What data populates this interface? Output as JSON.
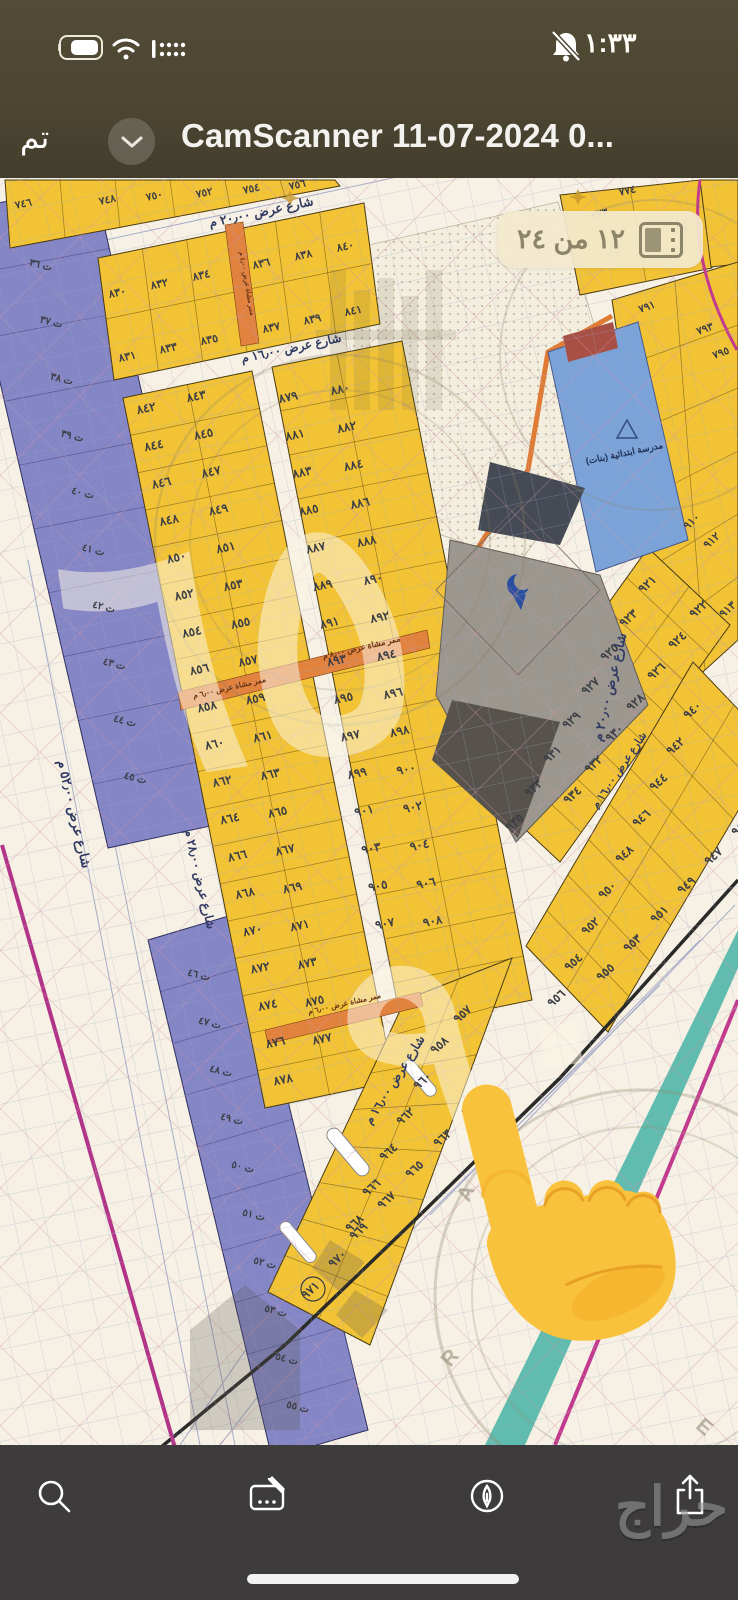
{
  "status_bar": {
    "time": "١:٣٣",
    "icons": [
      "battery-icon",
      "wifi-icon",
      "cellular-dots-icon",
      "bell-slash-icon"
    ]
  },
  "nav_bar": {
    "done_label": "تم",
    "collapse_icon": "chevron-down",
    "title": "CamScanner 11-07-2024 0..."
  },
  "page_badge": {
    "label": "١٢ من ٢٤",
    "icon": "pages-icon"
  },
  "toolbar": {
    "items": [
      {
        "name": "search",
        "icon": "magnifier-icon"
      },
      {
        "name": "markup",
        "icon": "markup-icon"
      },
      {
        "name": "annotate",
        "icon": "pen-circle-icon"
      },
      {
        "name": "share",
        "icon": "share-icon"
      }
    ]
  },
  "overlay": {
    "brand_watermark": "حراج",
    "pointer_emoji": "backhand-index-pointing-up"
  },
  "colors": {
    "plot_yellow": "#f2c335",
    "commercial_purple": "#8486c6",
    "school_blue": "#7ba3d8",
    "walkway_orange": "#e2823f",
    "boundary_teal": "#5fbcae",
    "boundary_magenta": "#b23488",
    "nav_bg": "#4a4432",
    "toolbar_bg": "#3d3b3c",
    "badge_bg": "#f2e9cd",
    "badge_text": "#8d8569"
  },
  "map": {
    "street_labels": [
      {
        "text": "شارع عرض ٢٠٫٠٠ م",
        "x": 262,
        "y": 216,
        "rot": -12,
        "size": 12.5
      },
      {
        "text": "شارع عرض ١٦٫٠٠ م",
        "x": 292,
        "y": 352,
        "rot": -12,
        "size": 12
      },
      {
        "text": "شارع عرض ٢٨٫٠٠ م",
        "x": 196,
        "y": 880,
        "rot": 77,
        "size": 12
      },
      {
        "text": "شارع عرض ٥٢٫٠٠ م",
        "x": 70,
        "y": 815,
        "rot": 77,
        "size": 13
      },
      {
        "text": "شارع عرض ٢٠٫٠٠ م",
        "x": 614,
        "y": 688,
        "rot": -77,
        "size": 13
      },
      {
        "text": "شارع عرض ١٦٫٠٠ م",
        "x": 622,
        "y": 772,
        "rot": -56,
        "size": 10.5
      },
      {
        "text": "شارع عرض ١٦٫٠٠ م",
        "x": 398,
        "y": 1082,
        "rot": -58,
        "size": 12
      }
    ],
    "walkway_labels": [
      {
        "text": "ممر مشاة عرض ٨٫٠٠ م",
        "x": 362,
        "y": 650,
        "rot": -13,
        "size": 8
      },
      {
        "text": "ممر مشاة عرض ٦٫٠٠ م",
        "x": 230,
        "y": 690,
        "rot": -13,
        "size": 7.5
      },
      {
        "text": "ممر مشاة عرض ٦٫٠٠ م",
        "x": 345,
        "y": 1006,
        "rot": -13,
        "size": 7.5
      },
      {
        "text": "ممر مشاة عرض ٤٫٠٠ م",
        "x": 245,
        "y": 284,
        "rot": 80,
        "size": 6.5
      }
    ],
    "poi_labels": [
      {
        "text": "مدرسة ابتدائية (بنات)",
        "x": 625,
        "y": 456,
        "rot": -12,
        "size": 9
      }
    ],
    "plot_series": [
      {
        "labels": [
          "٨٣٠",
          "٨٣٢",
          "٨٣٤"
        ],
        "x": 118,
        "y": 296,
        "dx": 42,
        "dy": -8.6,
        "rot": -12,
        "size": 11
      },
      {
        "labels": [
          "٨٣٦",
          "٨٣٨",
          "٨٤٠"
        ],
        "x": 262,
        "y": 267,
        "dx": 42,
        "dy": -8.6,
        "rot": -12,
        "size": 11
      },
      {
        "labels": [
          "٨٣١",
          "٨٣٣",
          "٨٣٥"
        ],
        "x": 128,
        "y": 360,
        "dx": 41,
        "dy": -8.4,
        "rot": -12,
        "size": 11
      },
      {
        "labels": [
          "٨٣٧",
          "٨٣٩",
          "٨٤١"
        ],
        "x": 272,
        "y": 331,
        "dx": 41,
        "dy": -8.4,
        "rot": -12,
        "size": 11
      },
      {
        "labels": [
          "٨٤٢",
          "٨٤٤",
          "٨٤٦",
          "٨٤٨",
          "٨٥٠",
          "٨٥٢",
          "٨٥٤",
          "٨٥٦",
          "٨٥٨",
          "٨٦٠",
          "٨٦٢",
          "٨٦٤",
          "٨٦٦",
          "٨٦٨",
          "٨٧٠",
          "٨٧٢",
          "٨٧٤",
          "٨٧٦",
          "٨٧٨"
        ],
        "x": 147,
        "y": 412,
        "dx": 7.6,
        "dy": 37.3,
        "rot": -12,
        "size": 12
      },
      {
        "labels": [
          "٨٤٣",
          "٨٤٥",
          "٨٤٧",
          "٨٤٩",
          "٨٥١",
          "٨٥٣",
          "٨٥٥",
          "٨٥٧",
          "٨٥٩",
          "٨٦١",
          "٨٦٣",
          "٨٦٥",
          "٨٦٧",
          "٨٦٩",
          "٨٧١",
          "٨٧٣",
          "٨٧٥",
          "٨٧٧"
        ],
        "x": 197,
        "y": 400,
        "dx": 7.4,
        "dy": 37.8,
        "rot": -12,
        "size": 12
      },
      {
        "labels": [
          "٨٧٩",
          "٨٨١",
          "٨٨٣",
          "٨٨٥",
          "٨٨٧",
          "٨٨٩",
          "٨٩١",
          "٨٩٣",
          "٨٩٥",
          "٨٩٧",
          "٨٩٩",
          "٩٠١",
          "٩٠٣",
          "٩٠٥",
          "٩٠٧"
        ],
        "x": 289,
        "y": 401,
        "dx": 6.9,
        "dy": 37.6,
        "rot": -12,
        "size": 12
      },
      {
        "labels": [
          "٨٨٠",
          "٨٨٢",
          "٨٨٤",
          "٨٨٦",
          "٨٨٨",
          "٨٩٠",
          "٨٩٢",
          "٨٩٤",
          "٨٩٦",
          "٨٩٨",
          "٩٠٠",
          "٩٠٢",
          "٩٠٤",
          "٩٠٦",
          "٩٠٨"
        ],
        "x": 341,
        "y": 393,
        "dx": 6.6,
        "dy": 38,
        "rot": -12,
        "size": 12
      },
      {
        "labels": [
          "٩٢١",
          "٩٢٣",
          "٩٢٥",
          "٩٢٧",
          "٩٢٩",
          "٩٣١",
          "٩٣٣",
          "٩٣٥"
        ],
        "x": 650,
        "y": 587,
        "dx": -19,
        "dy": 34,
        "rot": -42,
        "size": 12
      },
      {
        "labels": [
          "٩٢٢",
          "٩٢٤",
          "٩٢٦",
          "٩٢٨",
          "٩٣٠",
          "٩٣٢",
          "٩٣٤"
        ],
        "x": 701,
        "y": 612,
        "dx": -21,
        "dy": 31,
        "rot": -42,
        "size": 12
      },
      {
        "labels": [
          "٩٤٠",
          "٩٤٢",
          "٩٤٤",
          "٩٤٦",
          "٩٤٨",
          "٩٥٠",
          "٩٥٢",
          "٩٥٤",
          "٩٥٦"
        ],
        "x": 695,
        "y": 713,
        "dx": -17,
        "dy": 36,
        "rot": -42,
        "size": 12
      },
      {
        "labels": [
          "٩٤٥",
          "٩٤٧",
          "٩٤٩",
          "٩٥١",
          "٩٥٣",
          "٩٥٥"
        ],
        "x": 743,
        "y": 830,
        "dx": -27,
        "dy": 29,
        "rot": -42,
        "size": 12
      },
      {
        "labels": [
          "٩٥٨",
          "٩٦٠",
          "٩٦٢",
          "٩٦٤",
          "٩٦٦",
          "٩٦٨",
          "٩٧٠"
        ],
        "x": 442,
        "y": 1048,
        "dx": -17,
        "dy": 35.6,
        "rot": -42,
        "size": 12
      },
      {
        "labels": [
          "٩٦١",
          "٩٦٣",
          "٩٦٥",
          "٩٦٧",
          "٩٦٩"
        ],
        "x": 473,
        "y": 1110,
        "dx": -28,
        "dy": 31,
        "rot": -42,
        "size": 12
      },
      {
        "labels": [
          "ت ٣٦",
          "ت ٣٧",
          "ت ٣٨",
          "ت ٣٩",
          "ت ٤٠",
          "ت ٤١",
          "ت ٤٢",
          "ت ٤٣",
          "ت ٤٤",
          "ت ٤٥"
        ],
        "x": 40,
        "y": 268,
        "dx": 10.5,
        "dy": 57,
        "rot": 14,
        "size": 10
      },
      {
        "labels": [
          "ت ٤٦",
          "ت ٤٧",
          "ت ٤٨",
          "ت ٤٩",
          "ت ٥٠",
          "ت ٥١",
          "ت ٥٢",
          "ت ٥٣",
          "ت ٥٤",
          "ت ٥٥"
        ],
        "x": 198,
        "y": 978,
        "dx": 11,
        "dy": 48,
        "rot": 14,
        "size": 10
      }
    ],
    "plot_singles": [
      {
        "n": "٧٤٦",
        "x": 24,
        "y": 207,
        "rot": -12,
        "size": 10.5
      },
      {
        "n": "٧٤٨",
        "x": 108,
        "y": 203,
        "rot": -12,
        "size": 10.5
      },
      {
        "n": "٧٥٠",
        "x": 155,
        "y": 199,
        "rot": -12,
        "size": 10.5
      },
      {
        "n": "٧٥٢",
        "x": 205,
        "y": 196,
        "rot": -12,
        "size": 10.5
      },
      {
        "n": "٧٥٤",
        "x": 252,
        "y": 192,
        "rot": -12,
        "size": 10.5
      },
      {
        "n": "٧٥٦",
        "x": 298,
        "y": 188,
        "rot": -12,
        "size": 10.5
      },
      {
        "n": "٧٧٤",
        "x": 628,
        "y": 194,
        "rot": -12,
        "size": 10.5
      },
      {
        "n": "٧٧٣",
        "x": 600,
        "y": 217,
        "rot": -12,
        "size": 10.5
      },
      {
        "n": "٧٩١",
        "x": 648,
        "y": 310,
        "rot": -20,
        "size": 10.5
      },
      {
        "n": "٧٩٣",
        "x": 706,
        "y": 332,
        "rot": -20,
        "size": 10.5
      },
      {
        "n": "٧٩٥",
        "x": 722,
        "y": 356,
        "rot": -20,
        "size": 10.5
      },
      {
        "n": "٩١٠",
        "x": 694,
        "y": 524,
        "rot": -42,
        "size": 11
      },
      {
        "n": "٩١٢",
        "x": 714,
        "y": 543,
        "rot": -42,
        "size": 11
      },
      {
        "n": "٩١٣",
        "x": 730,
        "y": 612,
        "rot": -42,
        "size": 11
      },
      {
        "n": "٩٥٧",
        "x": 465,
        "y": 1017,
        "rot": -42,
        "size": 12
      },
      {
        "n": "٩٧١",
        "x": 313,
        "y": 1293,
        "rot": -42,
        "size": 12,
        "circled": true
      }
    ],
    "ghost_marks": [
      {
        "text": "٦٥",
        "x": 255,
        "y": 760,
        "size": 330,
        "rot": -8
      },
      {
        "text": "٩٠",
        "x": 500,
        "y": 1130,
        "size": 270,
        "rot": -8
      }
    ],
    "stamp_letters": [
      {
        "text": "R",
        "x": 455,
        "y": 1362,
        "rot": -50
      },
      {
        "text": "A",
        "x": 472,
        "y": 1196,
        "rot": -65
      },
      {
        "text": "E",
        "x": 700,
        "y": 1432,
        "rot": 40
      },
      {
        "text": "R",
        "x": 612,
        "y": 258,
        "rot": 20
      },
      {
        "text": "A",
        "x": 680,
        "y": 232,
        "rot": 35
      }
    ]
  }
}
